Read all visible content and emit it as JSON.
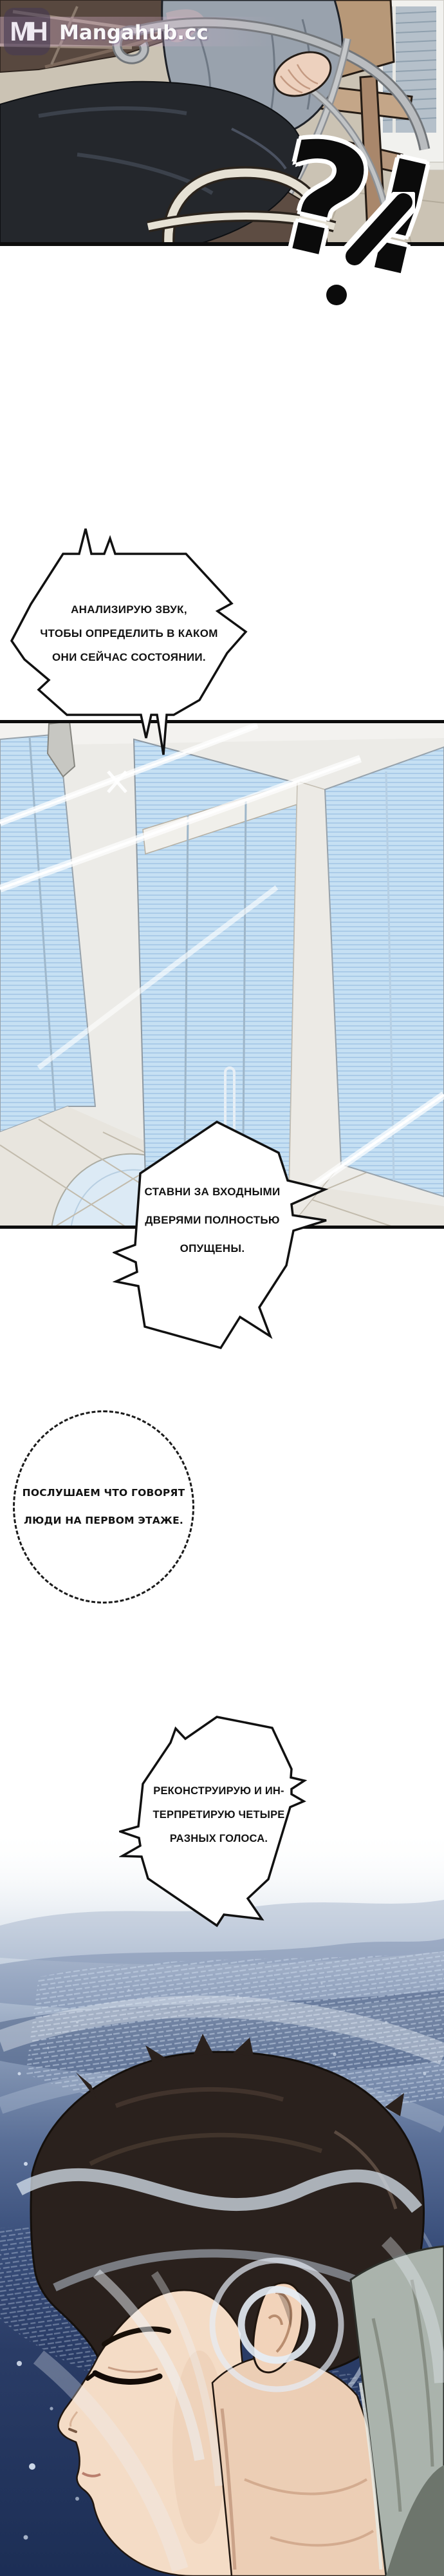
{
  "watermark": {
    "logo_initials": "MH",
    "site_name": "Mangahub.cc"
  },
  "sfx": {
    "text": "?!"
  },
  "bubbles": {
    "analyze": {
      "lines": [
        "АНАЛИЗИРУЮ ЗВУК,",
        "ЧТОБЫ ОПРЕДЕЛИТЬ В КАКОМ",
        "ОНИ СЕЙЧАС СОСТОЯНИИ."
      ]
    },
    "shutters": {
      "lines": [
        "СТАВНИ ЗА ВХОДНЫМИ",
        "ДВЕРЯМИ ПОЛНОСТЬЮ",
        "ОПУЩЕНЫ."
      ]
    },
    "listen": {
      "lines": [
        "ПОСЛУШАЕМ ЧТО ГОВОРЯТ",
        "ЛЮДИ НА ПЕРВОМ ЭТАЖЕ."
      ]
    },
    "voices": {
      "lines": [
        "РЕКОНСТРУИРУЮ И ИН-",
        "ТЕРПРЕТИРУЮ ЧЕТЫРЕ",
        "РАЗНЫХ ГОЛОСА."
      ]
    }
  },
  "colors": {
    "panel_border": "#0d0d0d",
    "bubble_fill": "#ffffff",
    "bubble_stroke": "#111111",
    "wall_beige": "#cbc3b4",
    "glass_blue": "#c6e0f3",
    "night_navy": "#1c2e55",
    "skin": "#f4dcc6",
    "hair": "#2a211d",
    "hoodie": "#aab3ac"
  }
}
